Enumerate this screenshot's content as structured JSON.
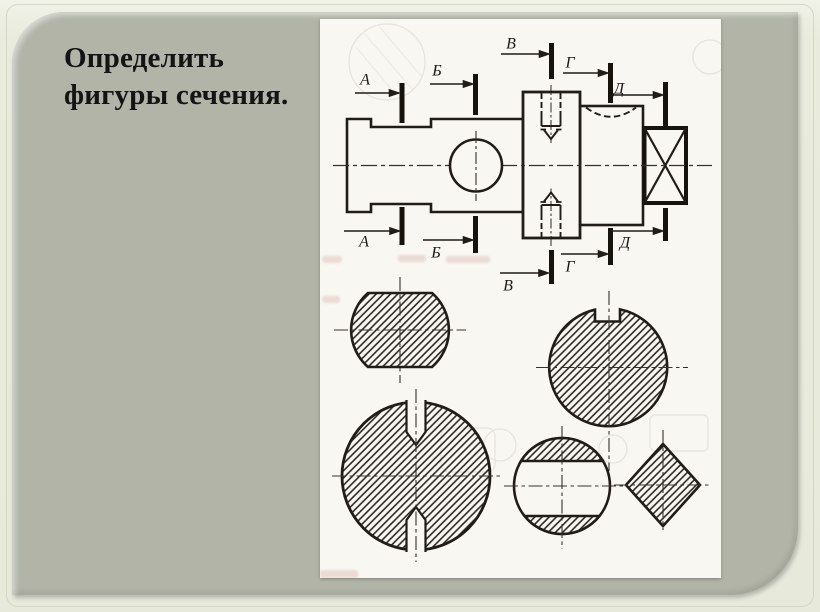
{
  "slide": {
    "title_line1": "Определить",
    "title_line2": "фигуры сечения."
  },
  "drawing": {
    "section_labels": [
      "А",
      "Б",
      "В",
      "Г",
      "Д"
    ],
    "figures": [
      "circle-with-top-bottom-flats",
      "circle-with-keyway-notch",
      "large-circle-with-two-keyway-slots",
      "circle-with-through-hole-band",
      "square-diamond-section"
    ]
  },
  "colors": {
    "frame": "#e9ebdd",
    "panel": "#b1b4a7",
    "paper": "#f8f7f2",
    "ink": "#211c16",
    "title_ink": "#141414"
  }
}
